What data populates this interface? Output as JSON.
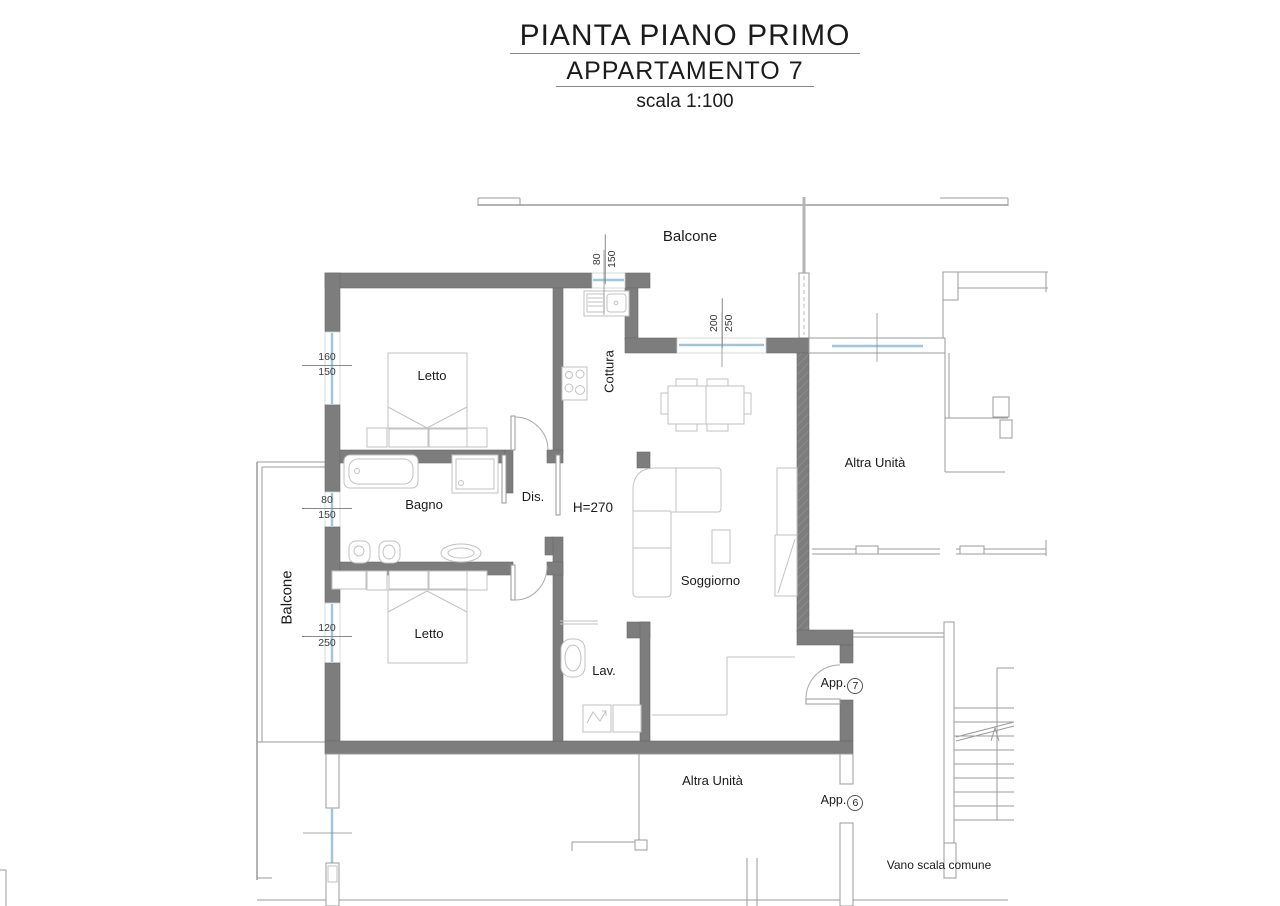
{
  "title": {
    "line1": "PIANTA PIANO PRIMO",
    "line2": "APPARTAMENTO 7",
    "line3": "scala 1:100"
  },
  "labels": {
    "bedroom": "Letto",
    "bathroom": "Bagno",
    "hallway": "Dis.",
    "laundry": "Lav.",
    "kitchen": "Cottura",
    "living": "Soggiorno",
    "balcony": "Balcone",
    "other_unit": "Altra Unità",
    "stairwell": "Vano scala comune",
    "ceiling_height": "H=270",
    "entrance_prefix": "App."
  },
  "entrances": {
    "app7": "7",
    "app6": "6"
  },
  "window_dims": {
    "letto1": {
      "w": "160",
      "h": "150"
    },
    "bagno": {
      "w": "80",
      "h": "150"
    },
    "letto2": {
      "w": "120",
      "h": "250"
    },
    "cottura": {
      "w": "80",
      "h": "150"
    },
    "soggiorno": {
      "w": "200",
      "h": "250"
    }
  },
  "colors": {
    "wall": "#7d7d7d",
    "wall_edge": "#696969",
    "thin_line": "#9b9b9b",
    "furniture": "#c2c2c2",
    "window": "#9fc6dd",
    "text": "#1b1b1b",
    "dim": "#3a3a3a"
  }
}
